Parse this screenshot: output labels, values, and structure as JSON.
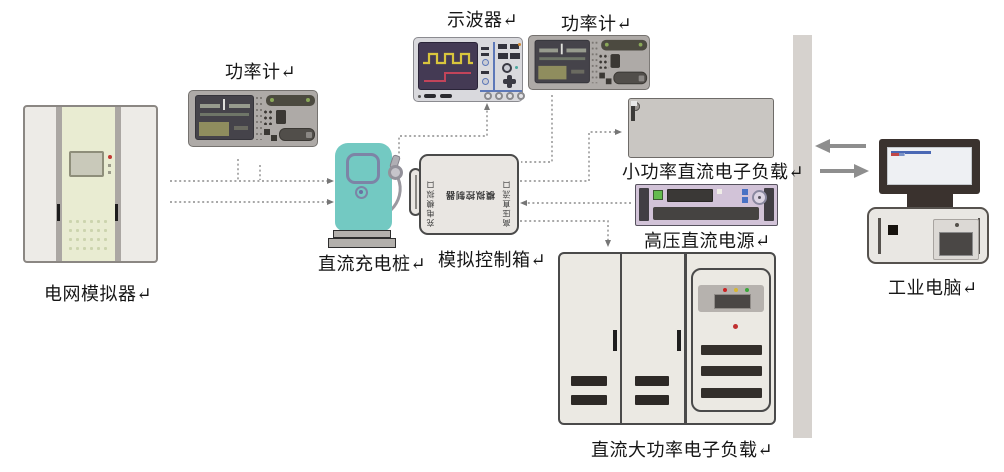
{
  "diagram": {
    "labels": {
      "grid_simulator": "电网模拟器↵",
      "power_meter_left": "功率计↵",
      "oscilloscope": "示波器↵",
      "power_meter_top": "功率计↵",
      "dc_charging_pile": "直流充电桩↵",
      "control_box": "模拟控制箱↵",
      "small_dc_load": "小功率直流电子负载↵",
      "hv_dc_supply": "高压直流电源↵",
      "dc_high_power_load": "直流大功率电子负载↵",
      "industrial_pc": "工业电脑↵"
    },
    "control_box_panel": {
      "center_text_rotated": "模拟控制器",
      "left_port_text_rotated": "充电模拟口",
      "right_port_text_rotated": "高压直流口"
    }
  },
  "palette": {
    "pile-teal": "#73c9c2",
    "pile-trim": "#7d84a6",
    "supply-lavender": "#d2c3d8",
    "scope-screen": "#443a54",
    "wave-yellow": "#d9c53d",
    "wave-red": "#c2445a",
    "line-gray": "#8c8c8c",
    "arrow-gray": "#8e8e8e",
    "bar-gray": "#d6d2ce",
    "cabinet-fill": "#ebe9e3",
    "panel-green": "#e9ecd2",
    "body-gray": "#aeaaa7",
    "dark-screen": "#3b3a38",
    "green-btn": "#63bb4e",
    "blue-btn": "#4a72c4"
  }
}
